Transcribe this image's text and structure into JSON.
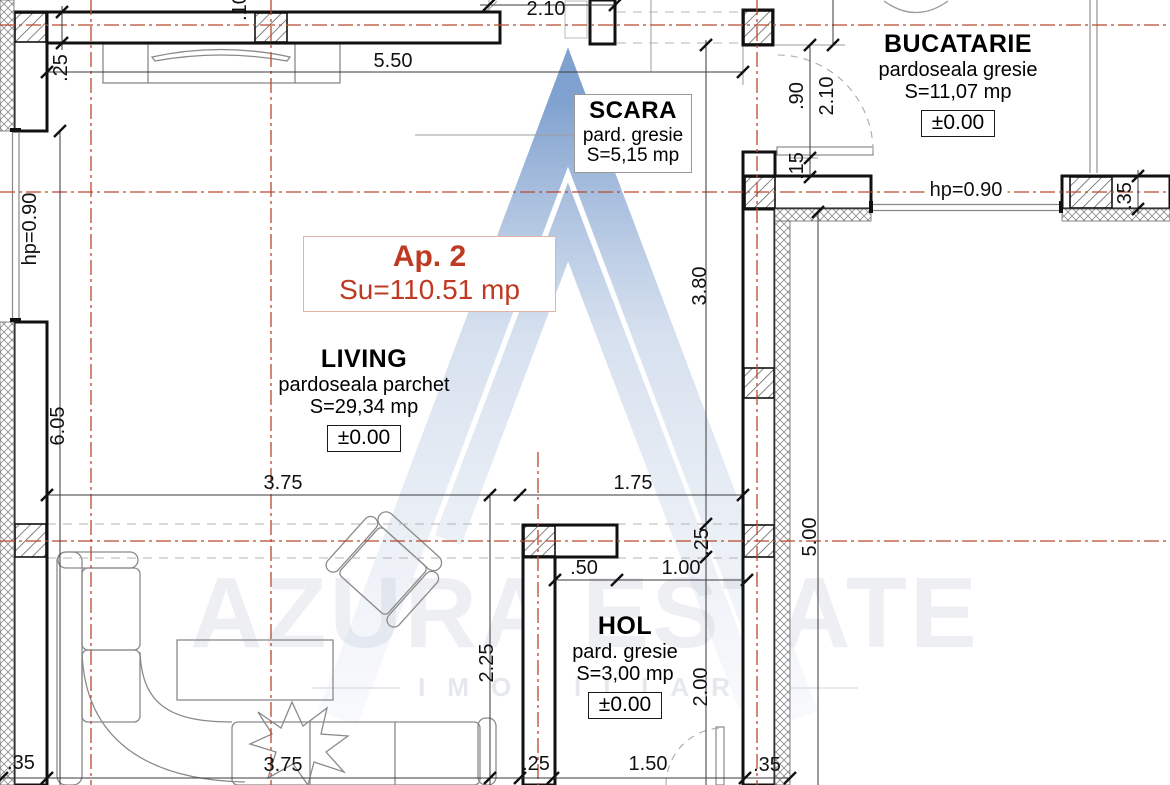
{
  "apartment": {
    "name": "Ap. 2",
    "area": "Su=110.51 mp"
  },
  "rooms": [
    {
      "name": "SCARA",
      "floor": "pard. gresie",
      "area": "S=5,15 mp"
    },
    {
      "name": "BUCATARIE",
      "floor": "pardoseala gresie",
      "area": "S=11,07 mp",
      "level": "±0.00"
    },
    {
      "name": "LIVING",
      "floor": "pardoseala parchet",
      "area": "S=29,34 mp",
      "level": "±0.00"
    },
    {
      "name": "HOL",
      "floor": "pard. gresie",
      "area": "S=3,00 mp",
      "level": "±0.00"
    }
  ],
  "annotations": [
    {
      "text": ".10",
      "x": 240,
      "y": 7,
      "rot": 90,
      "bg": false
    },
    {
      "text": "2.10",
      "x": 546,
      "y": 9,
      "rot": 0,
      "bg": false
    },
    {
      "text": ".25",
      "x": 61,
      "y": 68,
      "rot": 90,
      "bg": false
    },
    {
      "text": "5.50",
      "x": 393,
      "y": 61,
      "rot": 0,
      "bg": false
    },
    {
      "text": ".90",
      "x": 797,
      "y": 96,
      "rot": 90,
      "bg": false
    },
    {
      "text": "2.10",
      "x": 827,
      "y": 96,
      "rot": 90,
      "bg": false
    },
    {
      "text": ".15",
      "x": 797,
      "y": 166,
      "rot": 90,
      "bg": false
    },
    {
      "text": "hp=0.90",
      "x": 966,
      "y": 190,
      "rot": 0,
      "bg": true
    },
    {
      "text": ".35",
      "x": 1125,
      "y": 196,
      "rot": 90,
      "bg": false
    },
    {
      "text": "hp=0.90",
      "x": 30,
      "y": 229,
      "rot": 90,
      "bg": false
    },
    {
      "text": "3.80",
      "x": 700,
      "y": 286,
      "rot": 90,
      "bg": false
    },
    {
      "text": "6.05",
      "x": 58,
      "y": 426,
      "rot": 90,
      "bg": false
    },
    {
      "text": "3.75",
      "x": 283,
      "y": 483,
      "rot": 0,
      "bg": false
    },
    {
      "text": "1.75",
      "x": 633,
      "y": 483,
      "rot": 0,
      "bg": false
    },
    {
      "text": ".25",
      "x": 702,
      "y": 542,
      "rot": 90,
      "bg": false
    },
    {
      "text": "5.00",
      "x": 810,
      "y": 537,
      "rot": 90,
      "bg": false
    },
    {
      "text": ".50",
      "x": 584,
      "y": 568,
      "rot": 0,
      "bg": false
    },
    {
      "text": "1.00",
      "x": 681,
      "y": 568,
      "rot": 0,
      "bg": false
    },
    {
      "text": "2.25",
      "x": 487,
      "y": 663,
      "rot": 90,
      "bg": false
    },
    {
      "text": "2.00",
      "x": 701,
      "y": 687,
      "rot": 90,
      "bg": false
    },
    {
      "text": ".35",
      "x": 21,
      "y": 763,
      "rot": 0,
      "bg": false
    },
    {
      "text": "3.75",
      "x": 283,
      "y": 765,
      "rot": 0,
      "bg": false
    },
    {
      "text": ".25",
      "x": 536,
      "y": 764,
      "rot": 0,
      "bg": false
    },
    {
      "text": "1.50",
      "x": 648,
      "y": 764,
      "rot": 0,
      "bg": false
    },
    {
      "text": ".35",
      "x": 767,
      "y": 765,
      "rot": 0,
      "bg": false
    }
  ],
  "watermark": {
    "brand": "AZURA ESTATE",
    "tagline": "IMOBILIAR"
  },
  "colors": {
    "accent_red": "#bf3a22",
    "axis_red": "#b8492f",
    "wall_black": "#111111",
    "watermark_blue": "#7a9cc9"
  }
}
